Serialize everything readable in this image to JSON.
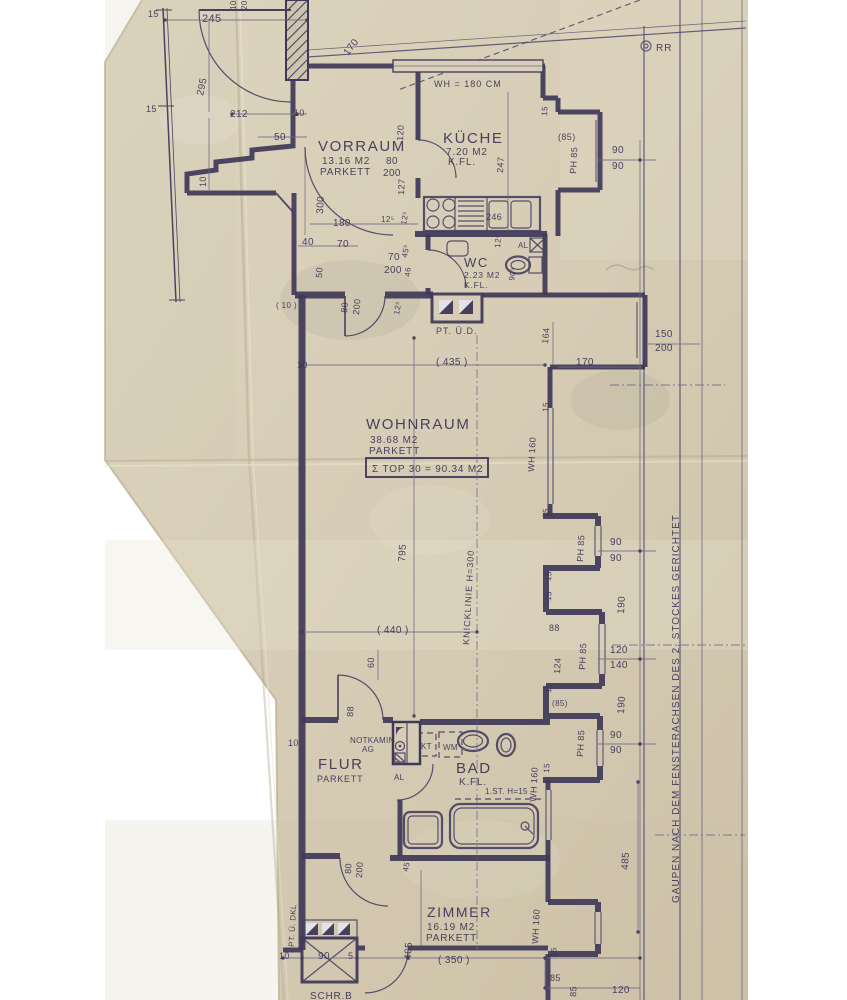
{
  "document": {
    "kind": "scanned architectural floor plan",
    "unit_label": "TOP 30",
    "total_label": "Σ TOP 30 = 90.34 M2"
  },
  "colors": {
    "paper": "#d7cdb6",
    "ink": "#3c3456",
    "margin": "#ffffff"
  },
  "rooms": [
    {
      "name": "VORRAUM",
      "area": "13.16 M2",
      "floor": "PARKETT"
    },
    {
      "name": "KÜCHE",
      "area": "7.20 M2",
      "floor": "K.FL."
    },
    {
      "name": "WC",
      "area": "2.23 M2",
      "floor": "K.FL."
    },
    {
      "name": "WOHNRAUM",
      "area": "38.68 M2",
      "floor": "PARKETT"
    },
    {
      "name": "FLUR",
      "area": "",
      "floor": "PARKETT"
    },
    {
      "name": "BAD",
      "area": "",
      "floor": "K.FL."
    },
    {
      "name": "ZIMMER",
      "area": "16.19 M2",
      "floor": "PARKETT"
    }
  ],
  "annotations": [
    {
      "n": "dim-15-a",
      "t": "15",
      "x": 148,
      "y": 17,
      "s": 9
    },
    {
      "n": "dim-245",
      "t": "245",
      "x": 202,
      "y": 22,
      "s": 11
    },
    {
      "n": "dim-10-top",
      "t": "10",
      "x": 236,
      "y": 10,
      "r": -90,
      "s": 8
    },
    {
      "n": "dim-20-top",
      "t": "20",
      "x": 247,
      "y": 10,
      "r": -90,
      "s": 8
    },
    {
      "n": "dim-295",
      "t": "295",
      "x": 203,
      "y": 96,
      "r": -78,
      "s": 10
    },
    {
      "n": "dim-170-door",
      "t": "170",
      "x": 348,
      "y": 56,
      "r": -52,
      "s": 10
    },
    {
      "n": "dim-15-b",
      "t": "15",
      "x": 146,
      "y": 112,
      "s": 9
    },
    {
      "n": "dim-212",
      "t": "212",
      "x": 230,
      "y": 117,
      "s": 10
    },
    {
      "n": "dim-10-b",
      "t": "10",
      "x": 294,
      "y": 116,
      "s": 9
    },
    {
      "n": "dim-50-a",
      "t": "50",
      "x": 274,
      "y": 140,
      "s": 10
    },
    {
      "n": "dim-10-c",
      "t": "10",
      "x": 206,
      "y": 187,
      "r": -90,
      "s": 9
    },
    {
      "n": "label-wh180",
      "t": "WH = 180 CM",
      "x": 434,
      "y": 87,
      "s": 9,
      "c": "note"
    },
    {
      "n": "label-rr",
      "t": "RR",
      "x": 656,
      "y": 51,
      "s": 10,
      "c": "note"
    },
    {
      "n": "room-kueche",
      "t": "KÜCHE",
      "x": 443,
      "y": 143,
      "s": 15,
      "c": "room"
    },
    {
      "n": "area-kueche",
      "t": "7.20 M2",
      "x": 446,
      "y": 155,
      "s": 10,
      "c": "sub"
    },
    {
      "n": "floor-kueche",
      "t": "K.FL.",
      "x": 448,
      "y": 165,
      "s": 10,
      "c": "sub"
    },
    {
      "n": "dim-85-bay1",
      "t": "(85)",
      "x": 558,
      "y": 140,
      "s": 9
    },
    {
      "n": "dim-ph85-bay1",
      "t": "PH 85",
      "x": 576,
      "y": 174,
      "r": -87,
      "s": 9
    },
    {
      "n": "dim-90-a",
      "t": "90",
      "x": 612,
      "y": 153,
      "s": 10
    },
    {
      "n": "dim-90-b",
      "t": "90",
      "x": 612,
      "y": 169,
      "s": 10
    },
    {
      "n": "dim-247",
      "t": "247",
      "x": 503,
      "y": 173,
      "r": -87,
      "s": 9
    },
    {
      "n": "dim-15-bay1",
      "t": "15",
      "x": 547,
      "y": 116,
      "r": -87,
      "s": 8
    },
    {
      "n": "dim-246",
      "t": "246",
      "x": 486,
      "y": 220,
      "s": 9
    },
    {
      "n": "room-vorraum",
      "t": "VORRAUM",
      "x": 318,
      "y": 151,
      "s": 15,
      "c": "room"
    },
    {
      "n": "area-vorraum",
      "t": "13.16 M2",
      "x": 322,
      "y": 164,
      "s": 10,
      "c": "sub"
    },
    {
      "n": "floor-vorraum",
      "t": "PARKETT",
      "x": 320,
      "y": 175,
      "s": 10,
      "c": "sub"
    },
    {
      "n": "dim-80-k",
      "t": "80",
      "x": 386,
      "y": 164,
      "s": 10
    },
    {
      "n": "dim-200-k",
      "t": "200",
      "x": 383,
      "y": 176,
      "s": 10
    },
    {
      "n": "dim-120-v",
      "t": "120",
      "x": 403,
      "y": 141,
      "r": -87,
      "s": 9
    },
    {
      "n": "dim-127-v",
      "t": "127",
      "x": 404,
      "y": 195,
      "r": -87,
      "s": 9
    },
    {
      "n": "dim-300-v",
      "t": "300",
      "x": 323,
      "y": 214,
      "r": -87,
      "s": 10
    },
    {
      "n": "dim-180",
      "t": "180",
      "x": 333,
      "y": 226,
      "s": 10
    },
    {
      "n": "dim-125-a",
      "t": "12⁵",
      "x": 381,
      "y": 222,
      "s": 8
    },
    {
      "n": "dim-125-b",
      "t": "12⁵",
      "x": 406,
      "y": 225,
      "r": -80,
      "s": 8
    },
    {
      "n": "dim-40",
      "t": "40",
      "x": 302,
      "y": 245,
      "s": 10
    },
    {
      "n": "dim-70-a",
      "t": "70",
      "x": 337,
      "y": 247,
      "s": 10
    },
    {
      "n": "dim-50-v",
      "t": "50",
      "x": 322,
      "y": 278,
      "r": -87,
      "s": 9
    },
    {
      "n": "dim-70-b",
      "t": "70",
      "x": 388,
      "y": 260,
      "s": 10
    },
    {
      "n": "dim-200-b",
      "t": "200",
      "x": 384,
      "y": 273,
      "s": 10
    },
    {
      "n": "dim-455-v",
      "t": "45⁵",
      "x": 407,
      "y": 258,
      "r": -80,
      "s": 8
    },
    {
      "n": "dim-46-v",
      "t": "46",
      "x": 410,
      "y": 277,
      "r": -85,
      "s": 8
    },
    {
      "n": "room-wc",
      "t": "WC",
      "x": 464,
      "y": 267,
      "s": 13,
      "c": "room"
    },
    {
      "n": "area-wc",
      "t": "2.23 M2",
      "x": 464,
      "y": 278,
      "s": 8.5,
      "c": "sub"
    },
    {
      "n": "floor-wc",
      "t": "K.FL.",
      "x": 464,
      "y": 288,
      "s": 8.5,
      "c": "sub"
    },
    {
      "n": "label-al-wc",
      "t": "AL",
      "x": 518,
      "y": 248,
      "s": 8,
      "c": "small"
    },
    {
      "n": "dim-125-c",
      "t": "12⁵",
      "x": 500,
      "y": 248,
      "r": -85,
      "s": 8
    },
    {
      "n": "dim-905",
      "t": "90⁵",
      "x": 514,
      "y": 281,
      "r": -80,
      "s": 8
    },
    {
      "n": "dim-paren10",
      "t": "( 10 )",
      "x": 276,
      "y": 308,
      "s": 8
    },
    {
      "n": "dim-80-e",
      "t": "80",
      "x": 347,
      "y": 313,
      "r": -85,
      "s": 9
    },
    {
      "n": "dim-200-e",
      "t": "200",
      "x": 359,
      "y": 315,
      "r": -85,
      "s": 9
    },
    {
      "n": "dim-125-d",
      "t": "12⁵",
      "x": 399,
      "y": 315,
      "r": -80,
      "s": 8
    },
    {
      "n": "label-pt-ued",
      "t": "PT. Ü.D.",
      "x": 436,
      "y": 334,
      "s": 9,
      "c": "note"
    },
    {
      "n": "dim-164",
      "t": "164",
      "x": 548,
      "y": 344,
      "r": -85,
      "s": 9
    },
    {
      "n": "dim-170-b",
      "t": "170",
      "x": 576,
      "y": 365,
      "s": 10
    },
    {
      "n": "dim-150",
      "t": "150",
      "x": 655,
      "y": 337,
      "s": 10
    },
    {
      "n": "dim-200-w",
      "t": "200",
      "x": 655,
      "y": 351,
      "s": 10
    },
    {
      "n": "dim-435",
      "t": "( 435 )",
      "x": 436,
      "y": 365,
      "s": 10
    },
    {
      "n": "dim-10-d",
      "t": "10",
      "x": 297,
      "y": 368,
      "s": 9
    },
    {
      "n": "room-wohnraum",
      "t": "WOHNRAUM",
      "x": 366,
      "y": 429,
      "s": 15,
      "c": "room"
    },
    {
      "n": "area-wohnraum",
      "t": "38.68 M2",
      "x": 370,
      "y": 443,
      "s": 10,
      "c": "sub"
    },
    {
      "n": "floor-wohnraum",
      "t": "PARKETT",
      "x": 369,
      "y": 454,
      "s": 10,
      "c": "sub"
    },
    {
      "n": "label-top-sum",
      "t": "Σ TOP 30 = 90.34 M2",
      "x": 372,
      "y": 472,
      "s": 10,
      "c": "sub"
    },
    {
      "n": "dim-wh160-a",
      "t": "WH 160",
      "x": 534,
      "y": 472,
      "r": -87,
      "s": 9
    },
    {
      "n": "dim-15-c",
      "t": "15",
      "x": 548,
      "y": 412,
      "r": -87,
      "s": 8
    },
    {
      "n": "dim-15-d",
      "t": "15",
      "x": 548,
      "y": 518,
      "r": -87,
      "s": 8
    },
    {
      "n": "dim-795",
      "t": "795",
      "x": 405,
      "y": 562,
      "r": -87,
      "s": 10
    },
    {
      "n": "label-knicklinie",
      "t": "KNICKLINIE  H=300",
      "x": 469,
      "y": 645,
      "r": -87,
      "s": 9,
      "c": "note"
    },
    {
      "n": "dim-440",
      "t": "( 440 )",
      "x": 377,
      "y": 633,
      "s": 10
    },
    {
      "n": "dim-60",
      "t": "60",
      "x": 374,
      "y": 668,
      "r": -90,
      "s": 9
    },
    {
      "n": "dim-88-door",
      "t": "88",
      "x": 353,
      "y": 717,
      "r": -87,
      "s": 9
    },
    {
      "n": "dim-90-c",
      "t": "90",
      "x": 610,
      "y": 545,
      "s": 10
    },
    {
      "n": "dim-90-d",
      "t": "90",
      "x": 610,
      "y": 561,
      "s": 10
    },
    {
      "n": "dim-ph85-b",
      "t": "PH 85",
      "x": 583,
      "y": 562,
      "r": -87,
      "s": 9
    },
    {
      "n": "dim-190-a",
      "t": "190",
      "x": 624,
      "y": 614,
      "r": -87,
      "s": 10
    },
    {
      "n": "dim-15-e",
      "t": "15",
      "x": 551,
      "y": 581,
      "r": -87,
      "s": 8
    },
    {
      "n": "dim-15-f",
      "t": "15",
      "x": 551,
      "y": 601,
      "r": -87,
      "s": 8
    },
    {
      "n": "dim-88-b",
      "t": "88",
      "x": 549,
      "y": 631,
      "s": 9
    },
    {
      "n": "dim-124",
      "t": "124",
      "x": 560,
      "y": 674,
      "r": -87,
      "s": 9
    },
    {
      "n": "dim-ph85-c",
      "t": "PH 85",
      "x": 585,
      "y": 670,
      "r": -87,
      "s": 9
    },
    {
      "n": "dim-120",
      "t": "120",
      "x": 610,
      "y": 653,
      "s": 10
    },
    {
      "n": "dim-140",
      "t": "140",
      "x": 610,
      "y": 668,
      "s": 10
    },
    {
      "n": "dim-190-b",
      "t": "190",
      "x": 624,
      "y": 714,
      "r": -87,
      "s": 10
    },
    {
      "n": "dim-15-g",
      "t": "15",
      "x": 551,
      "y": 693,
      "r": -87,
      "s": 8
    },
    {
      "n": "dim-85-c",
      "t": "(85)",
      "x": 552,
      "y": 706,
      "s": 8
    },
    {
      "n": "dim-ph85-d",
      "t": "PH 85",
      "x": 583,
      "y": 757,
      "r": -87,
      "s": 9
    },
    {
      "n": "dim-90-e",
      "t": "90",
      "x": 610,
      "y": 738,
      "s": 10
    },
    {
      "n": "dim-90-f",
      "t": "90",
      "x": 610,
      "y": 753,
      "s": 10
    },
    {
      "n": "dim-10-e",
      "t": "10",
      "x": 288,
      "y": 746,
      "s": 9
    },
    {
      "n": "label-notkamin",
      "t": "NOTKAMIN",
      "x": 350,
      "y": 743,
      "s": 8,
      "c": "small"
    },
    {
      "n": "label-ag",
      "t": "AG",
      "x": 362,
      "y": 752,
      "s": 8,
      "c": "small"
    },
    {
      "n": "label-kt",
      "t": "KT",
      "x": 421,
      "y": 749,
      "s": 8,
      "c": "small"
    },
    {
      "n": "label-wm",
      "t": "WM",
      "x": 443,
      "y": 750,
      "s": 8,
      "c": "small"
    },
    {
      "n": "label-al-b",
      "t": "AL",
      "x": 394,
      "y": 780,
      "s": 8,
      "c": "small"
    },
    {
      "n": "room-flur",
      "t": "FLUR",
      "x": 318,
      "y": 769,
      "s": 15,
      "c": "room"
    },
    {
      "n": "floor-flur",
      "t": "PARKETT",
      "x": 317,
      "y": 782,
      "s": 9,
      "c": "sub"
    },
    {
      "n": "room-bad",
      "t": "BAD",
      "x": 456,
      "y": 773,
      "s": 15,
      "c": "room"
    },
    {
      "n": "floor-bad",
      "t": "K.FL.",
      "x": 459,
      "y": 785,
      "s": 10,
      "c": "sub"
    },
    {
      "n": "label-stufe",
      "t": "1.ST. H=15",
      "x": 485,
      "y": 794,
      "s": 8,
      "c": "small"
    },
    {
      "n": "dim-wh160-b",
      "t": "WH 160",
      "x": 536,
      "y": 802,
      "r": -87,
      "s": 9
    },
    {
      "n": "dim-15-h",
      "t": "15",
      "x": 549,
      "y": 773,
      "r": -87,
      "s": 8
    },
    {
      "n": "dim-80-z",
      "t": "80",
      "x": 351,
      "y": 874,
      "r": -87,
      "s": 9
    },
    {
      "n": "dim-200-z",
      "t": "200",
      "x": 362,
      "y": 878,
      "r": -87,
      "s": 9
    },
    {
      "n": "dim-45-z",
      "t": "45",
      "x": 408,
      "y": 872,
      "r": -80,
      "s": 8
    },
    {
      "n": "room-zimmer",
      "t": "ZIMMER",
      "x": 427,
      "y": 917,
      "s": 14,
      "c": "room"
    },
    {
      "n": "area-zimmer",
      "t": "16.19 M2",
      "x": 427,
      "y": 930,
      "s": 10,
      "c": "sub"
    },
    {
      "n": "floor-zimmer",
      "t": "PARKETT",
      "x": 426,
      "y": 941,
      "s": 10,
      "c": "sub"
    },
    {
      "n": "label-pt-dkl",
      "t": "PT. Ü. DKL",
      "x": 294,
      "y": 947,
      "r": -87,
      "s": 8,
      "c": "small"
    },
    {
      "n": "dim-wh160-c",
      "t": "WH 160",
      "x": 538,
      "y": 944,
      "r": -87,
      "s": 9
    },
    {
      "n": "dim-15-i",
      "t": "15",
      "x": 556,
      "y": 957,
      "r": -87,
      "s": 8
    },
    {
      "n": "dim-10-f",
      "t": "10",
      "x": 279,
      "y": 959,
      "s": 9
    },
    {
      "n": "dim-90-g",
      "t": "90",
      "x": 318,
      "y": 959,
      "s": 10
    },
    {
      "n": "dim-5",
      "t": "5",
      "x": 348,
      "y": 959,
      "s": 9
    },
    {
      "n": "dim-405",
      "t": "405",
      "x": 411,
      "y": 960,
      "r": -87,
      "s": 10
    },
    {
      "n": "dim-350",
      "t": "( 350 )",
      "x": 438,
      "y": 963,
      "s": 10
    },
    {
      "n": "dim-85-d",
      "t": "85",
      "x": 550,
      "y": 981,
      "s": 9
    },
    {
      "n": "dim-85-e",
      "t": "85",
      "x": 576,
      "y": 997,
      "r": -87,
      "s": 9
    },
    {
      "n": "dim-120-b",
      "t": "120",
      "x": 612,
      "y": 993,
      "s": 10
    },
    {
      "n": "label-schrb",
      "t": "SCHR.B",
      "x": 310,
      "y": 999,
      "s": 10,
      "c": "sub"
    },
    {
      "n": "dim-485",
      "t": "485",
      "x": 628,
      "y": 870,
      "r": -87,
      "s": 10
    },
    {
      "n": "label-gaupen",
      "t": "GAUPEN  NACH  DEM  FENSTERACHSEN  DES  2. STOCKES  GERICHTET",
      "x": 679,
      "y": 903,
      "r": -90,
      "s": 10,
      "c": "note"
    }
  ]
}
